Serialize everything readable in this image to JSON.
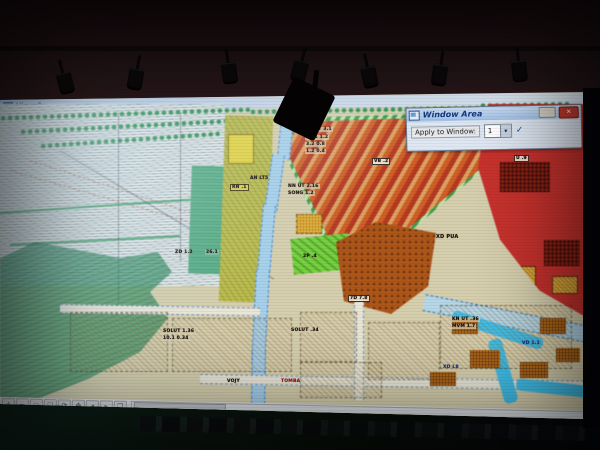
{
  "window": {
    "title": "View 1"
  },
  "dialog": {
    "title": "Window Area",
    "apply_label": "Apply to Window:",
    "window_number": "1",
    "dropdown_arrow": "▾",
    "close_glyph": "✕",
    "check_glyph": "✓"
  },
  "view_toolbar": {
    "buttons": [
      {
        "name": "zoom-in",
        "glyph": "+"
      },
      {
        "name": "zoom-out",
        "glyph": "−"
      },
      {
        "name": "window-area",
        "glyph": "▭"
      },
      {
        "name": "fit-view",
        "glyph": "◱"
      },
      {
        "name": "rotate-view",
        "glyph": "⟳"
      },
      {
        "name": "pan-view",
        "glyph": "✥"
      },
      {
        "name": "view-previous",
        "glyph": "◂"
      },
      {
        "name": "view-next",
        "glyph": "▸"
      },
      {
        "name": "copy-view",
        "glyph": "❐"
      }
    ]
  },
  "map": {
    "colors": {
      "paper": "#d6cfae",
      "forest": "#248456",
      "teal_parcel": "#58a983",
      "olive_parcel": "#b9ba54",
      "hatch_orange": "#c8602c",
      "hatch_red": "#ae3c26",
      "red_zone": "#bf3430",
      "orange_zone": "#a8571f",
      "bright_green": "#7ccf49",
      "river": "#49bde4",
      "road_casing": "#3a6fa8"
    },
    "labels": [
      {
        "text": "KD 23.1",
        "x": 296,
        "y": 112,
        "cls": "dk"
      },
      {
        "text": "SOLUT 3.1",
        "x": 303,
        "y": 127,
        "cls": "blk"
      },
      {
        "text": "25.1  1.2",
        "x": 305,
        "y": 135,
        "cls": "blk"
      },
      {
        "text": "3.2  0.8",
        "x": 305,
        "y": 142,
        "cls": "blk"
      },
      {
        "text": "1.2  0.4",
        "x": 305,
        "y": 149,
        "cls": "blk"
      },
      {
        "text": "VB .2",
        "x": 372,
        "y": 158,
        "cls": "box"
      },
      {
        "text": "U .9",
        "x": 514,
        "y": 155,
        "cls": "box"
      },
      {
        "text": "RN .1",
        "x": 230,
        "y": 184,
        "cls": "box-y"
      },
      {
        "text": "AN LT5",
        "x": 250,
        "y": 176,
        "cls": ""
      },
      {
        "text": "NN UT 2.16",
        "x": 287,
        "y": 184,
        "cls": "blk"
      },
      {
        "text": "SONG 1.2",
        "x": 287,
        "y": 191,
        "cls": "blk"
      },
      {
        "text": "ZD 1.2",
        "x": 175,
        "y": 250,
        "cls": ""
      },
      {
        "text": "26.1",
        "x": 205,
        "y": 250,
        "cls": "box-t"
      },
      {
        "text": "2P .4",
        "x": 303,
        "y": 254,
        "cls": ""
      },
      {
        "text": "XD PUA",
        "x": 436,
        "y": 234,
        "cls": "dk"
      },
      {
        "text": "7D 7.8",
        "x": 348,
        "y": 295,
        "cls": "box"
      },
      {
        "text": "SOLUT 1.36",
        "x": 162,
        "y": 329,
        "cls": "blk"
      },
      {
        "text": "10.1  0.34",
        "x": 162,
        "y": 336,
        "cls": "blk"
      },
      {
        "text": "SOLUT .34",
        "x": 290,
        "y": 328,
        "cls": "blk"
      },
      {
        "text": "KN UT .36",
        "x": 451,
        "y": 317,
        "cls": "blk"
      },
      {
        "text": "MVM 1.7",
        "x": 451,
        "y": 324,
        "cls": "blk"
      },
      {
        "text": "VD 1.1",
        "x": 522,
        "y": 341,
        "cls": "blu"
      },
      {
        "text": "XD L8",
        "x": 443,
        "y": 365,
        "cls": "blu"
      },
      {
        "text": "TOMBA",
        "x": 281,
        "y": 379,
        "cls": "red"
      },
      {
        "text": "VOJY",
        "x": 227,
        "y": 379,
        "cls": ""
      }
    ]
  }
}
